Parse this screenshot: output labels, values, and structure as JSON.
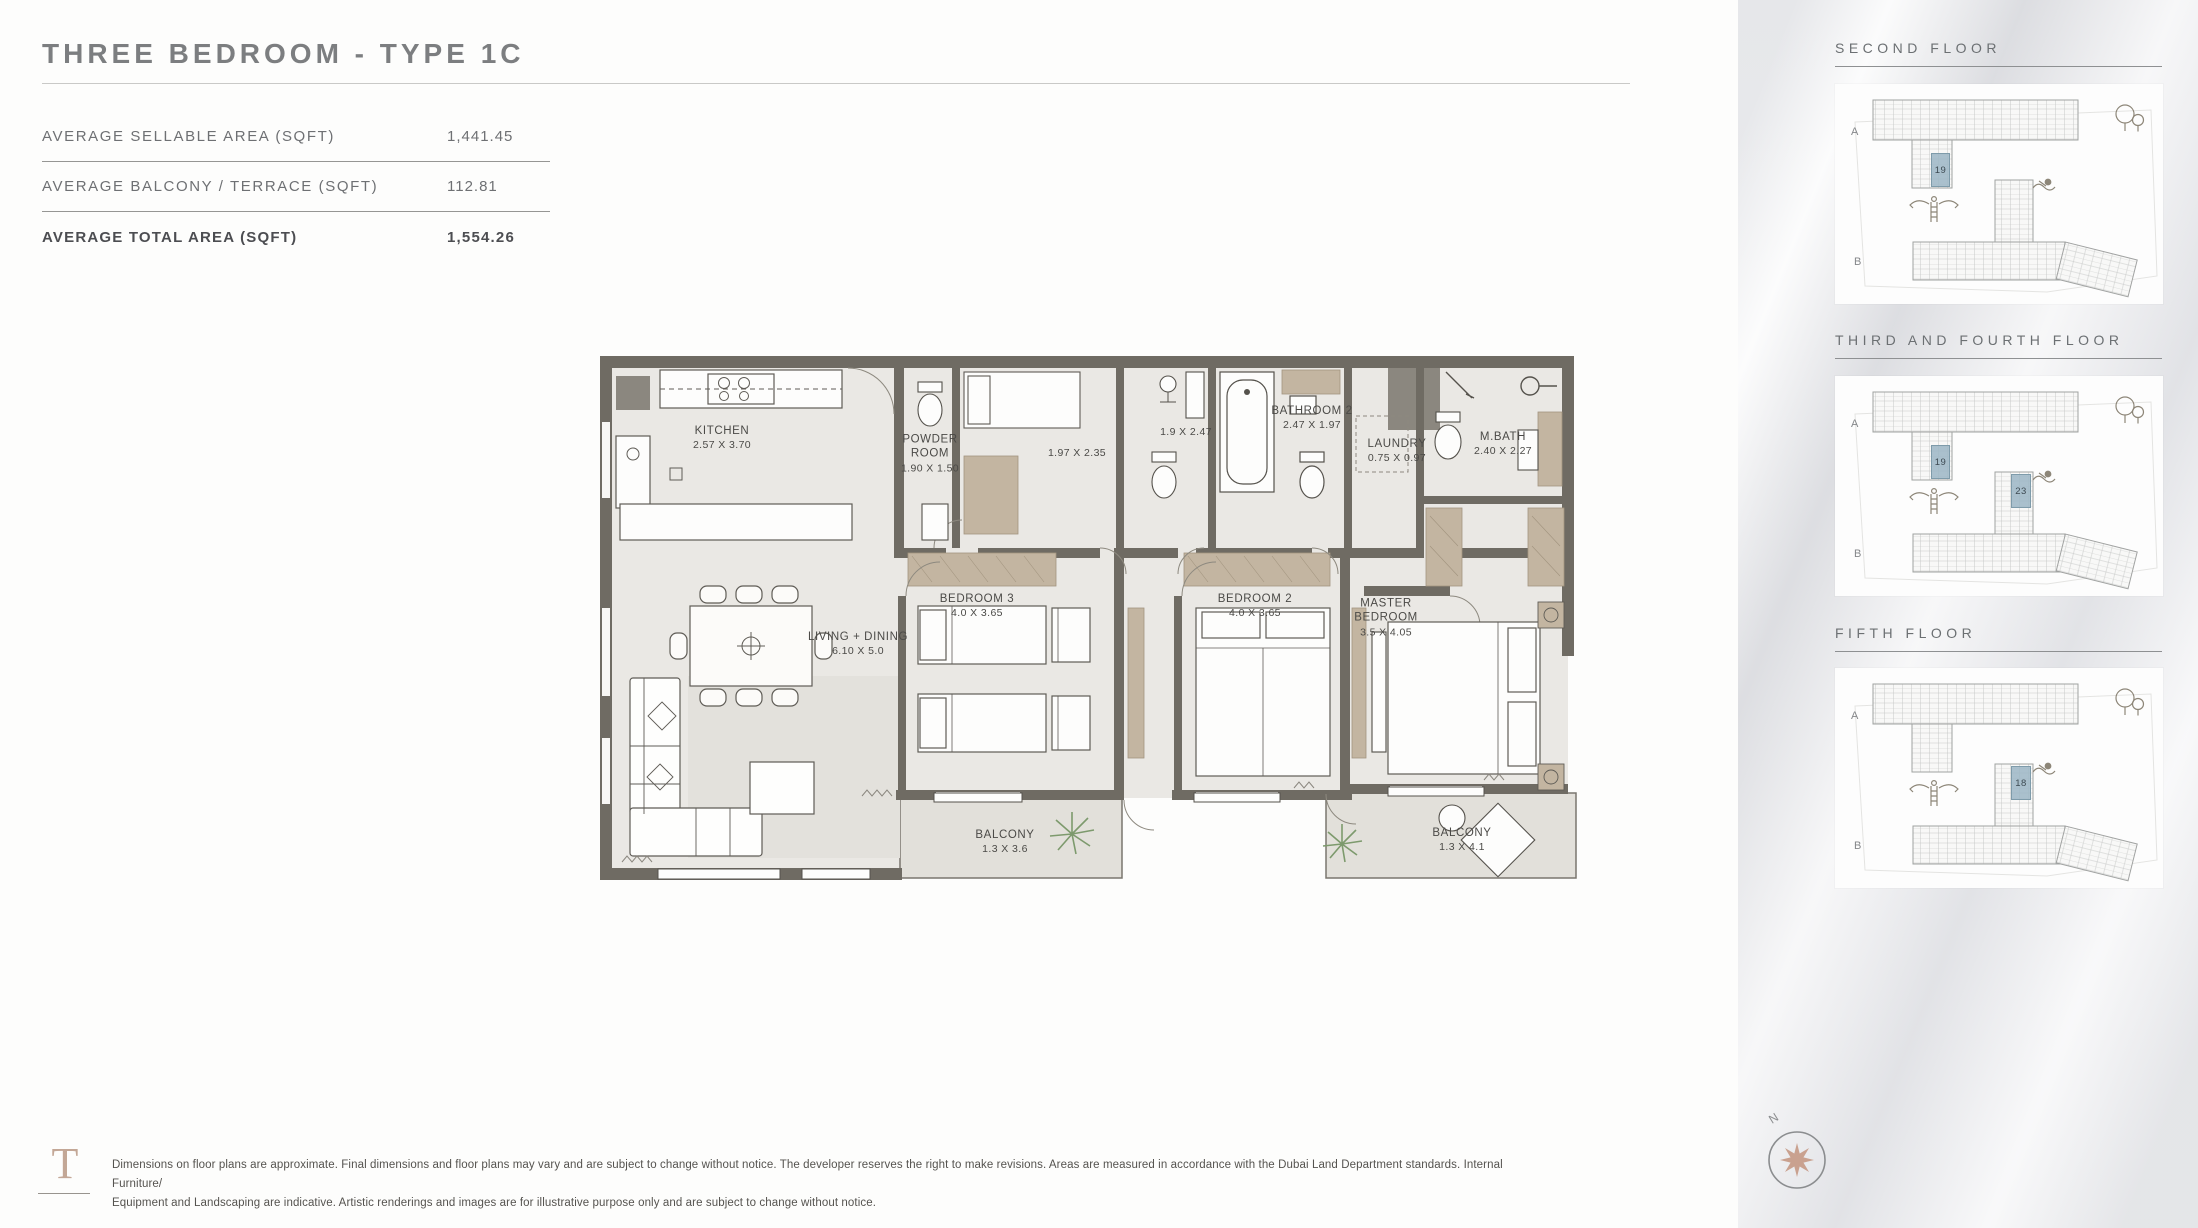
{
  "page": {
    "title": "THREE BEDROOM - TYPE 1C"
  },
  "area_table": {
    "rows": [
      {
        "label": "AVERAGE SELLABLE AREA (SQFT)",
        "value": "1,441.45"
      },
      {
        "label": "AVERAGE BALCONY / TERRACE (SQFT)",
        "value": "112.81"
      },
      {
        "label": "AVERAGE TOTAL AREA (SQFT)",
        "value": "1,554.26"
      }
    ]
  },
  "floorplan": {
    "rooms": [
      {
        "name": "KITCHEN",
        "dims": "2.57 X 3.70",
        "x": 122,
        "y": 82
      },
      {
        "name": "POWDER\nROOM",
        "dims": "1.90 X 1.50",
        "x": 330,
        "y": 98
      },
      {
        "name": "",
        "dims": "1.97 X 2.35",
        "x": 477,
        "y": 97
      },
      {
        "name": "",
        "dims": "1.9 X 2.47",
        "x": 586,
        "y": 76
      },
      {
        "name": "BATHROOM 2",
        "dims": "2.47 X 1.97",
        "x": 712,
        "y": 62
      },
      {
        "name": "LAUNDRY",
        "dims": "0.75 X 0.97",
        "x": 797,
        "y": 95
      },
      {
        "name": "M.BATH",
        "dims": "2.40 X 2.27",
        "x": 903,
        "y": 88
      },
      {
        "name": "LIVING + DINING",
        "dims": "6.10 X 5.0",
        "x": 258,
        "y": 288
      },
      {
        "name": "BEDROOM 3",
        "dims": "4.0 X 3.65",
        "x": 377,
        "y": 250
      },
      {
        "name": "BEDROOM 2",
        "dims": "4.0 X 3.65",
        "x": 655,
        "y": 250
      },
      {
        "name": "MASTER\nBEDROOM",
        "dims": "3.5 X 4.05",
        "x": 786,
        "y": 262
      },
      {
        "name": "BALCONY",
        "dims": "1.3 X 3.6",
        "x": 405,
        "y": 486
      },
      {
        "name": "BALCONY",
        "dims": "1.3 X 4.1",
        "x": 862,
        "y": 484
      }
    ]
  },
  "sidebar": {
    "sections": [
      {
        "title": "SECOND FLOOR",
        "label_a": "A",
        "label_b": "B",
        "units": [
          {
            "number": "19",
            "x": 96,
            "y": 69,
            "w": 19,
            "h": 34
          }
        ]
      },
      {
        "title": "THIRD AND FOURTH FLOOR",
        "label_a": "A",
        "label_b": "B",
        "units": [
          {
            "number": "19",
            "x": 96,
            "y": 69,
            "w": 19,
            "h": 34
          },
          {
            "number": "23",
            "x": 176,
            "y": 98,
            "w": 20,
            "h": 34
          }
        ]
      },
      {
        "title": "FIFTH FLOOR",
        "label_a": "A",
        "label_b": "B",
        "units": [
          {
            "number": "18",
            "x": 176,
            "y": 98,
            "w": 20,
            "h": 34
          }
        ]
      }
    ]
  },
  "footer": {
    "logo_letter": "T",
    "disclaimer_line1": "Dimensions on floor plans are approximate. Final dimensions and floor plans may vary and are subject to change without notice. The developer reserves the right to make revisions. Areas are measured in accordance with the Dubai Land Department standards. Internal Furniture/",
    "disclaimer_line2": "Equipment and Landscaping are indicative. Artistic renderings and images are for illustrative purpose only and are subject to change without notice.",
    "compass_label": "N"
  },
  "colors": {
    "wall": "#6f6b63",
    "floor": "#eae8e4",
    "balcony_floor": "#e2e0da",
    "wardrobe": "#c3b5a1",
    "unit_highlight": "#9cb6c5",
    "logo": "#c3a796",
    "compass_star": "#c9a18f",
    "plant": "#7d9a6d"
  }
}
